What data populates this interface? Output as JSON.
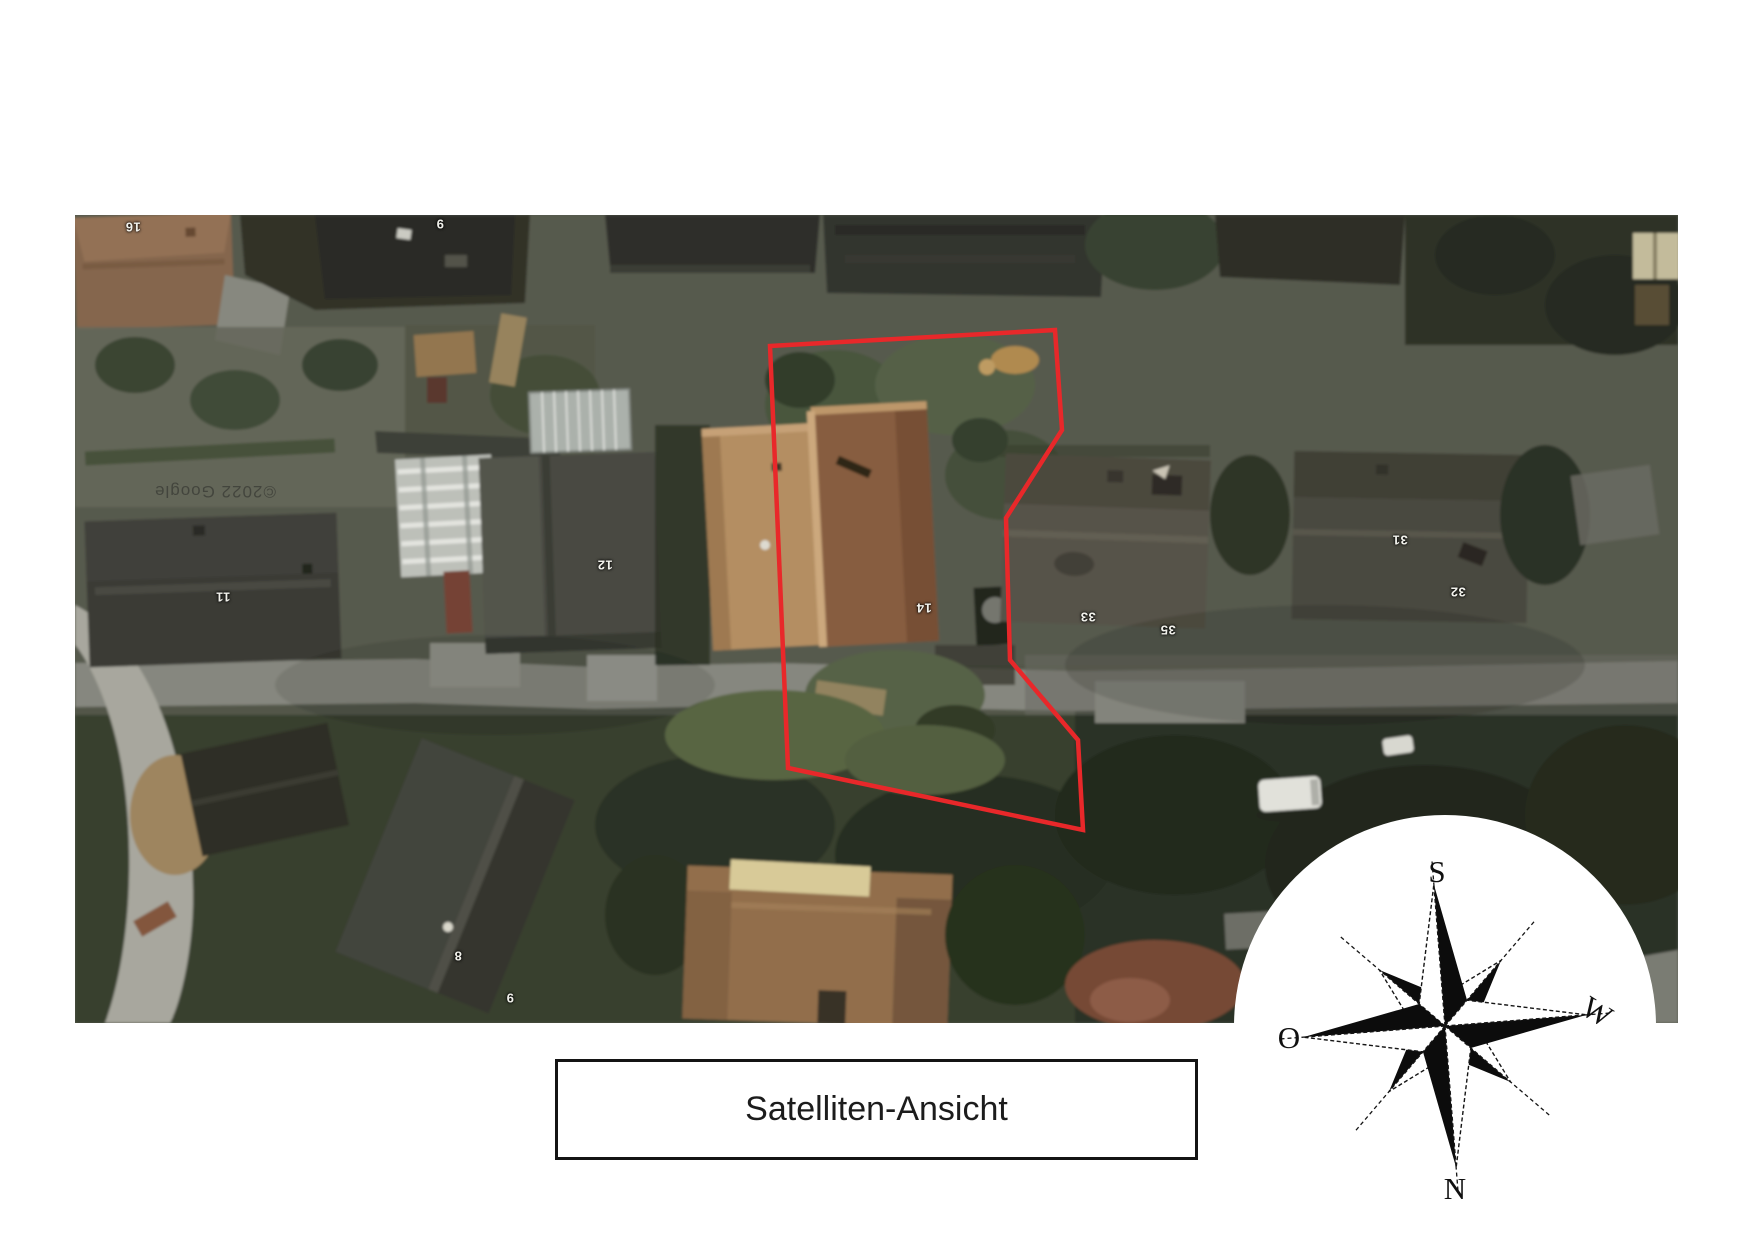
{
  "page": {
    "background": "#ffffff"
  },
  "caption": {
    "text": "Satelliten-Ansicht"
  },
  "compass": {
    "top": "S",
    "right": "W",
    "bottom": "N",
    "left": "O"
  },
  "map": {
    "watermark": "©2022 Google",
    "boundary_color": "#e8282a",
    "parcel_points": "695,131 980,115 987,215 931,303 935,445 1003,525 1008,615 713,553",
    "house_numbers": [
      {
        "label": "16",
        "x": 58,
        "y": 12
      },
      {
        "label": "9",
        "x": 365,
        "y": 9
      },
      {
        "label": "11",
        "x": 148,
        "y": 382
      },
      {
        "label": "12",
        "x": 530,
        "y": 350
      },
      {
        "label": "14",
        "x": 849,
        "y": 393
      },
      {
        "label": "33",
        "x": 1013,
        "y": 402
      },
      {
        "label": "35",
        "x": 1093,
        "y": 415
      },
      {
        "label": "31",
        "x": 1325,
        "y": 325
      },
      {
        "label": "32",
        "x": 1383,
        "y": 377
      },
      {
        "label": "8",
        "x": 383,
        "y": 741
      },
      {
        "label": "9",
        "x": 435,
        "y": 783
      }
    ]
  }
}
